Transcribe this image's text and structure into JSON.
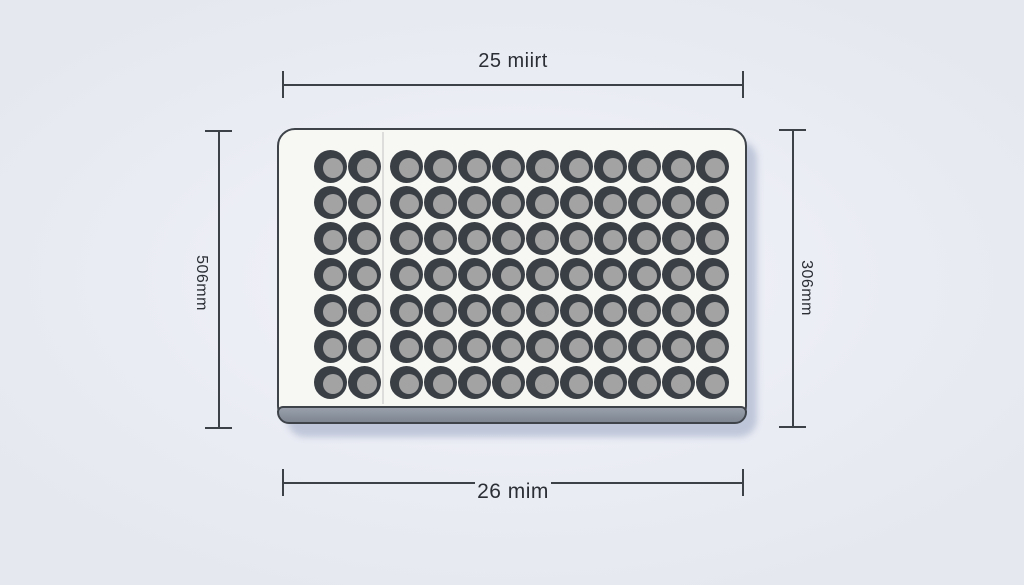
{
  "figure": {
    "type": "microplate-dimension-diagram",
    "plate": {
      "rows": 7,
      "cols": 12,
      "gap_after_col": 2,
      "well_ring_color": "#3a3f45",
      "well_inner_color": "#a3a3a3",
      "face_color": "#f7f7f4",
      "side_color": "#868e9a",
      "outline_color": "#3e434a"
    },
    "dimensions": {
      "top": {
        "label": "25 miirt"
      },
      "bottom": {
        "label": "26 mim"
      },
      "left": {
        "label": "506mm"
      },
      "right": {
        "label": "306mm"
      }
    },
    "colors": {
      "background": "#eaecf4",
      "dimension_line": "#3c4148",
      "text": "#2b2f35",
      "shadow": "#b9c2d6"
    }
  }
}
